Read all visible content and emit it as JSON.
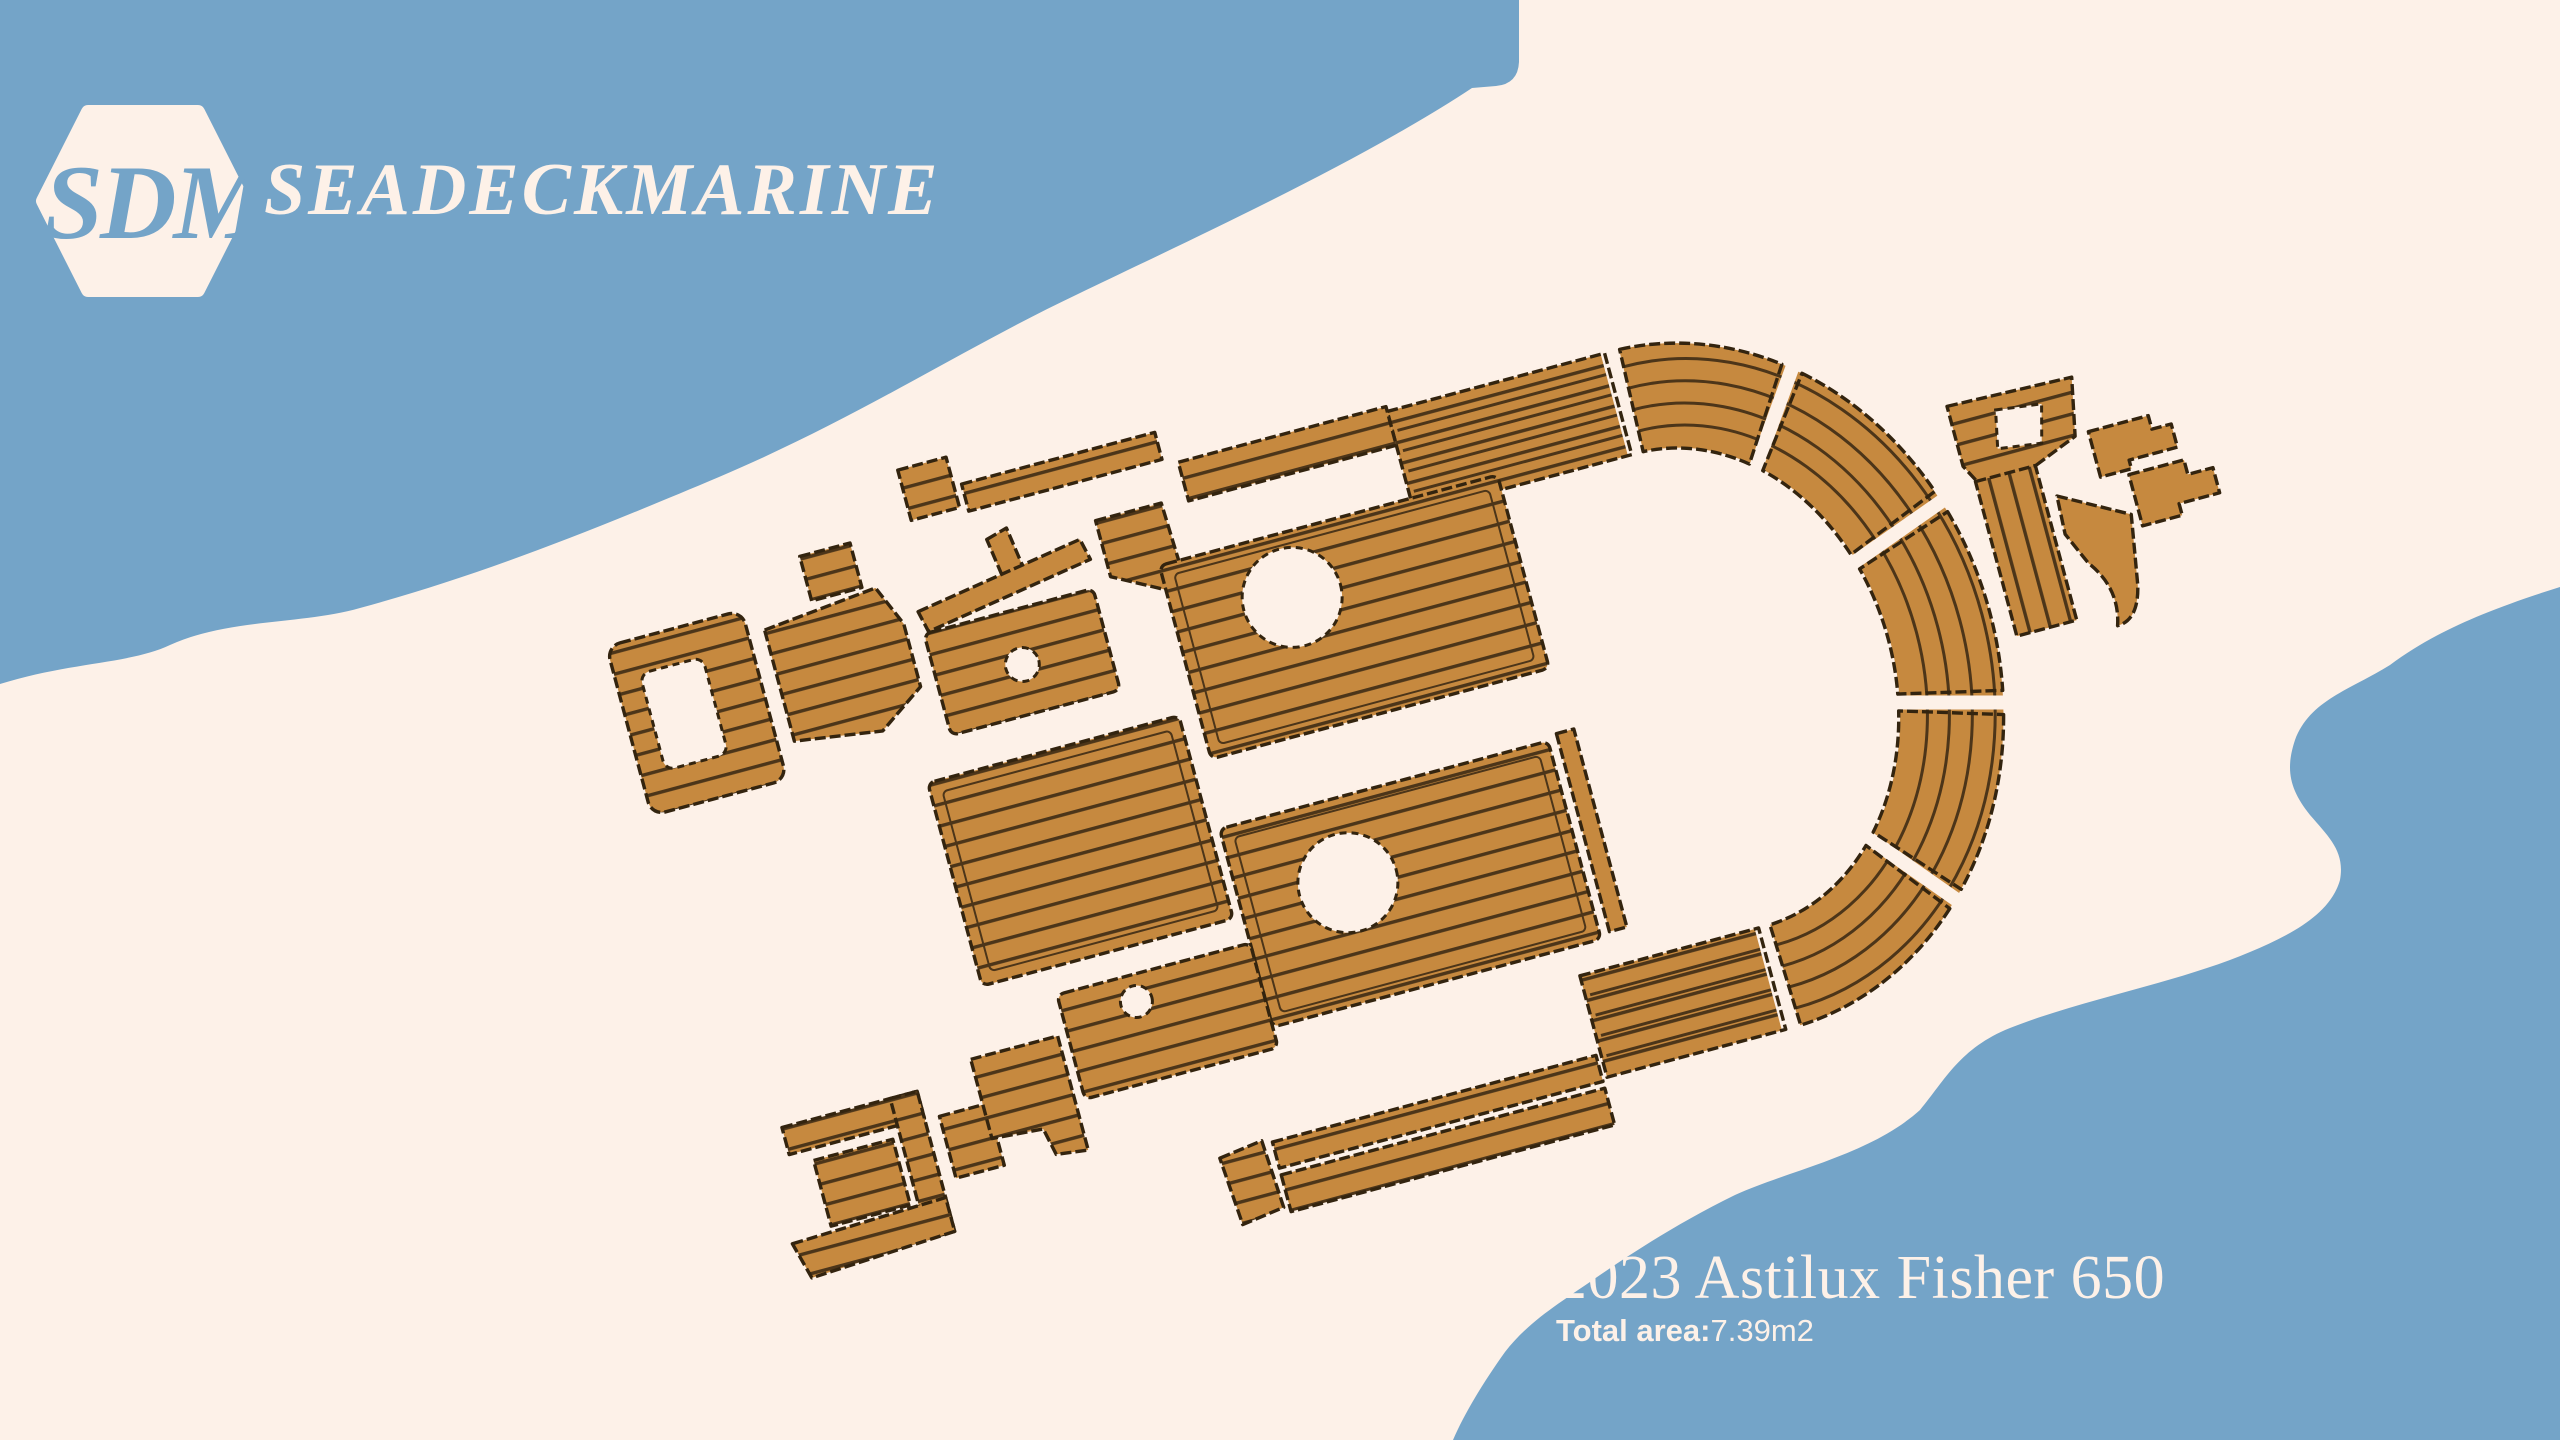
{
  "brand": {
    "monogram": "SDM",
    "name": "SEADECKMARINE"
  },
  "product": {
    "title": "2023 Astilux Fisher 650",
    "total_area_label": "Total area:",
    "total_area_value": "7.39m2"
  },
  "colors": {
    "ocean_blue": "#74a4c8",
    "cream": "#fdf1e8",
    "teak": "#c6893f",
    "teak_groove": "#4c3519",
    "teak_edge": "#33240f"
  }
}
